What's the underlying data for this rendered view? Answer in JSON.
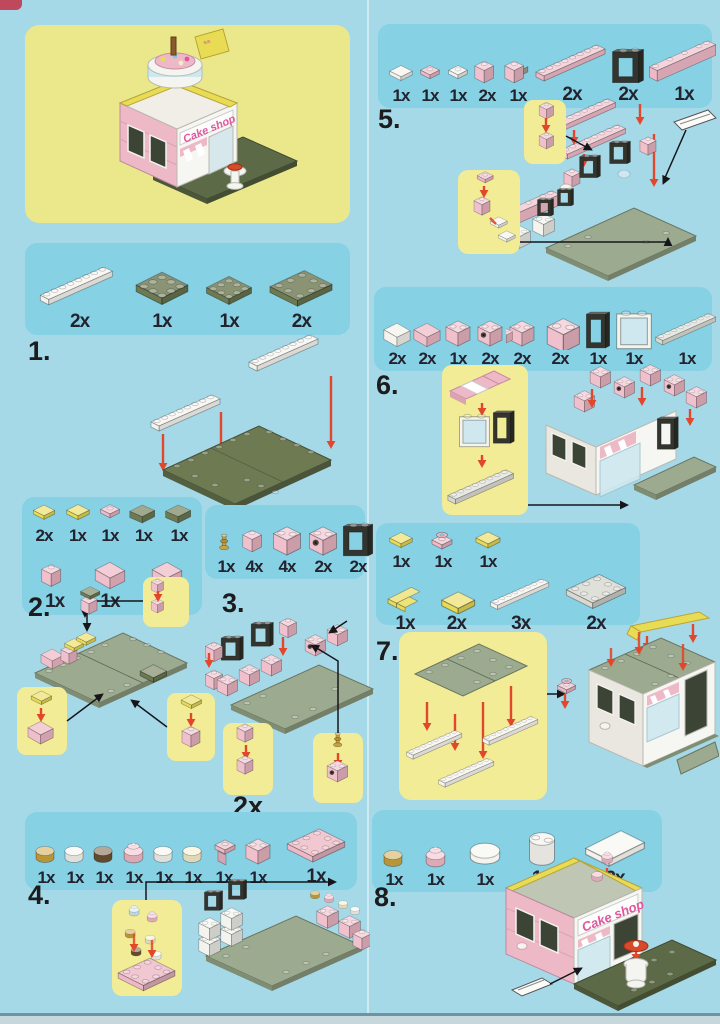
{
  "document_type": "brick-set building instructions",
  "model_name": "Cake shop",
  "hero": {
    "sign_text": "Cake shop"
  },
  "colors": {
    "page_bg": "#a6d9e8",
    "parts_panel_bg": "#87d1e5",
    "callout_bg": "#f1ec95",
    "hero_panel_bg": "#ebe88c",
    "brick_pink": "#eeb9c6",
    "baseplate_olive": "#6d7a52",
    "baseplate_sage": "#9cab90",
    "accent_yellow": "#e9dc55",
    "arrow_red": "#e2472b",
    "sign_text_pink": "#e0569f"
  },
  "steps": [
    {
      "number": "1.",
      "parts": [
        {
          "name": "white-1x8-plate",
          "count": "2x"
        },
        {
          "name": "olive-6x6-plate",
          "count": "1x"
        },
        {
          "name": "olive-4x6-plate",
          "count": "1x"
        },
        {
          "name": "olive-6x8-plate",
          "count": "2x"
        }
      ]
    },
    {
      "number": "2.",
      "parts": [
        {
          "name": "yellow-1x2-tile",
          "count": "2x"
        },
        {
          "name": "yellow-1x1-tile",
          "count": "1x"
        },
        {
          "name": "pink-1x1-plate",
          "count": "1x"
        },
        {
          "name": "olive-slope",
          "count": "1x"
        },
        {
          "name": "olive-wedge",
          "count": "1x"
        },
        {
          "name": "pink-1x1-brick",
          "count": "1x"
        },
        {
          "name": "pink-slope",
          "count": "1x"
        },
        {
          "name": "pink-slope-2",
          "count": "1x"
        }
      ]
    },
    {
      "number": "3.",
      "callout_count": "2x",
      "parts": [
        {
          "name": "gold-candle-pin",
          "count": "1x"
        },
        {
          "name": "pink-1x1-brick",
          "count": "4x"
        },
        {
          "name": "pink-1x2-brick",
          "count": "4x"
        },
        {
          "name": "pink-1x2-technic-brick",
          "count": "2x"
        },
        {
          "name": "black-window-frame",
          "count": "2x"
        }
      ]
    },
    {
      "number": "4.",
      "parts": [
        {
          "name": "gold-round-tile",
          "count": "1x"
        },
        {
          "name": "white-round-tile",
          "count": "1x"
        },
        {
          "name": "brown-round-tile",
          "count": "1x"
        },
        {
          "name": "pink-cupcake",
          "count": "1x"
        },
        {
          "name": "white-round-tile-2",
          "count": "1x"
        },
        {
          "name": "cream-round-tile",
          "count": "1x"
        },
        {
          "name": "pink-bracket",
          "count": "1x"
        },
        {
          "name": "pink-1x2-brick",
          "count": "1x"
        },
        {
          "name": "pink-2x4-plate",
          "count": "1x"
        }
      ]
    },
    {
      "number": "5.",
      "parts": [
        {
          "name": "white-1x2-tile",
          "count": "1x"
        },
        {
          "name": "pink-1x1-plate",
          "count": "1x"
        },
        {
          "name": "white-1x1-round-plate",
          "count": "1x"
        },
        {
          "name": "pink-1x1-brick",
          "count": "2x"
        },
        {
          "name": "pink-clip-brick",
          "count": "1x"
        },
        {
          "name": "pink-1x8-plate",
          "count": "2x"
        },
        {
          "name": "black-window-frame",
          "count": "2x"
        },
        {
          "name": "pink-1x8-brick",
          "count": "1x"
        }
      ]
    },
    {
      "number": "6.",
      "parts": [
        {
          "name": "white-slope",
          "count": "2x"
        },
        {
          "name": "pink-slope",
          "count": "2x"
        },
        {
          "name": "pink-1x2-brick",
          "count": "1x"
        },
        {
          "name": "pink-1x2-technic-brick",
          "count": "2x"
        },
        {
          "name": "pink-corner-brick",
          "count": "2x"
        },
        {
          "name": "pink-1x4-brick",
          "count": "2x"
        },
        {
          "name": "black-door-frame",
          "count": "1x"
        },
        {
          "name": "white-glass-panel",
          "count": "1x"
        },
        {
          "name": "grey-1x8-plate",
          "count": "1x"
        }
      ]
    },
    {
      "number": "7.",
      "parts": [
        {
          "name": "yellow-1x1-tile",
          "count": "1x"
        },
        {
          "name": "pink-ring-plate",
          "count": "1x"
        },
        {
          "name": "yellow-1x2-tile",
          "count": "1x"
        },
        {
          "name": "yellow-corner-plate",
          "count": "1x"
        },
        {
          "name": "yellow-1x4-tile",
          "count": "2x"
        },
        {
          "name": "white-1x8-plate",
          "count": "3x"
        },
        {
          "name": "grey-6x8-plate",
          "count": "2x"
        }
      ]
    },
    {
      "number": "8.",
      "sign_text": "Cake shop",
      "parts": [
        {
          "name": "gold-round-tile",
          "count": "1x"
        },
        {
          "name": "pink-cupcake",
          "count": "1x"
        },
        {
          "name": "white-2x2-round-tile",
          "count": "1x"
        },
        {
          "name": "white-2x2-round-brick",
          "count": "1x"
        },
        {
          "name": "white-2x4-tile",
          "count": "2x"
        }
      ]
    }
  ]
}
